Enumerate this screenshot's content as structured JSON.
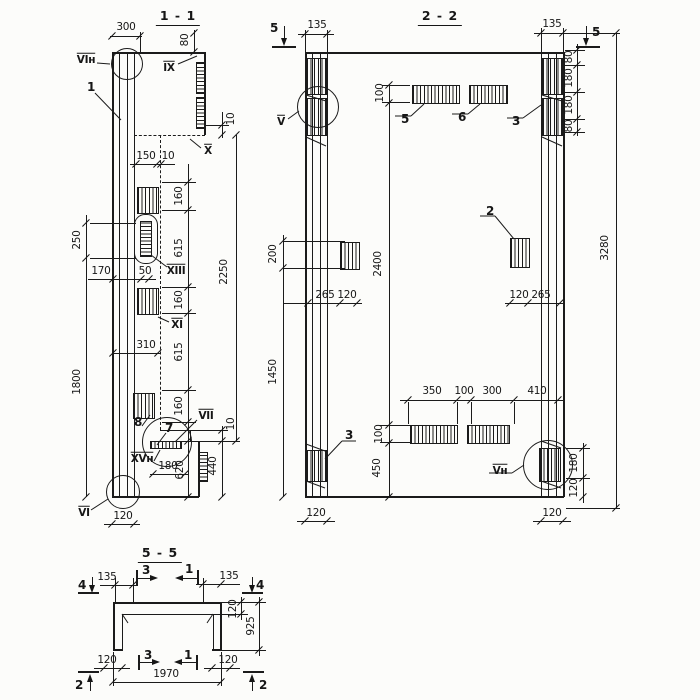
{
  "s1": {
    "title": "1 - 1",
    "p1": "1",
    "p7": "7",
    "p8": "8",
    "n_vin": "VIн",
    "n_ix": "IX",
    "n_x": "X",
    "n_xiii": "XIII",
    "n_xi": "XI",
    "n_vii": "VII",
    "n_xvn": "XVн",
    "n_vi": "VI",
    "d300": "300",
    "d80": "80",
    "d10a": "10",
    "d150": "150",
    "d10b": "10",
    "d160a": "160",
    "d615a": "615",
    "d160b": "160",
    "d615b": "615",
    "d160c": "160",
    "d2250": "2250",
    "d170": "170",
    "d50": "50",
    "d310": "310",
    "d250": "250",
    "d1800": "1800",
    "d10c": "10",
    "d440": "440",
    "d180": "180",
    "d620": "620",
    "d120": "120"
  },
  "s2": {
    "title": "2 - 2",
    "cut5": "5",
    "p2": "2",
    "p3": "3",
    "p5": "5",
    "p6": "6",
    "n_v": "V",
    "n_vn": "Vн",
    "d135": "135",
    "d100t": "100",
    "d80a": "80",
    "d180a": "180",
    "d180b": "180",
    "d80b": "80",
    "d3280": "3280",
    "d200": "200",
    "d1450": "1450",
    "d2400": "2400",
    "d265": "265",
    "d120": "120",
    "d350": "350",
    "d100m": "100",
    "d300": "300",
    "d410": "410",
    "d100b": "100",
    "d450": "450",
    "d180r": "180"
  },
  "s5": {
    "title": "5 - 5",
    "cut4": "4",
    "cut2": "2",
    "cut3": "3",
    "cut1": "1",
    "d135": "135",
    "d120": "120",
    "d925": "925",
    "d1970": "1970"
  }
}
